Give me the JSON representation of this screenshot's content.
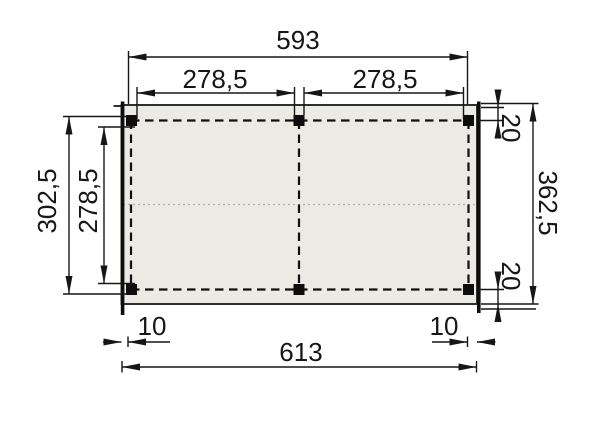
{
  "drawing": {
    "type": "floor-plan-dimension-drawing",
    "colors": {
      "background": "#ffffff",
      "line": "#161616",
      "roof_fill": "#eceae5",
      "roof_stroke": "#2f2f2f",
      "post_fill": "#0d0d0d",
      "dotted_mid_line": "#b0aeaa"
    },
    "dimensions": {
      "top_total": "593",
      "top_span_left": "278,5",
      "top_span_right": "278,5",
      "side_left_outer": "302,5",
      "side_left_inner": "278,5",
      "side_right_total": "362,5",
      "side_right_top": "20",
      "side_right_bottom": "20",
      "bottom_offset_left": "10",
      "bottom_offset_right": "10",
      "bottom_total": "613"
    }
  }
}
